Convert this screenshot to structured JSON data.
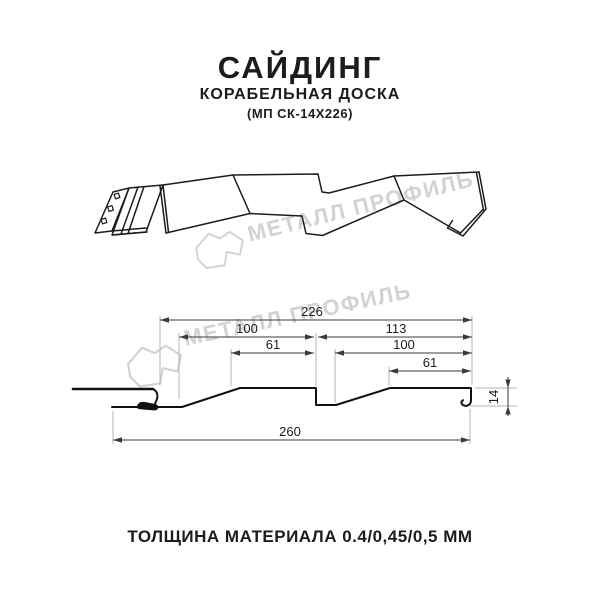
{
  "header": {
    "title": "САЙДИНГ",
    "subtitle": "КОРАБЕЛЬНАЯ ДОСКА",
    "model": "(МП СК-14Х226)"
  },
  "watermark": {
    "text": "МЕТАЛЛ ПРОФИЛЬ",
    "color": "#d2d2d2"
  },
  "footer": {
    "thickness": "ТОЛЩИНА МАТЕРИАЛА 0.4/0,45/0,5 ММ"
  },
  "drawing": {
    "type": "siding-profile-technical-drawing",
    "units": "mm",
    "dimensions": {
      "overall_coverage": "226",
      "board1_width": "100",
      "board1_face": "61",
      "board2_width": "113",
      "board2_inner": "100",
      "board2_face": "61",
      "total_width": "260",
      "profile_depth": "14"
    }
  }
}
